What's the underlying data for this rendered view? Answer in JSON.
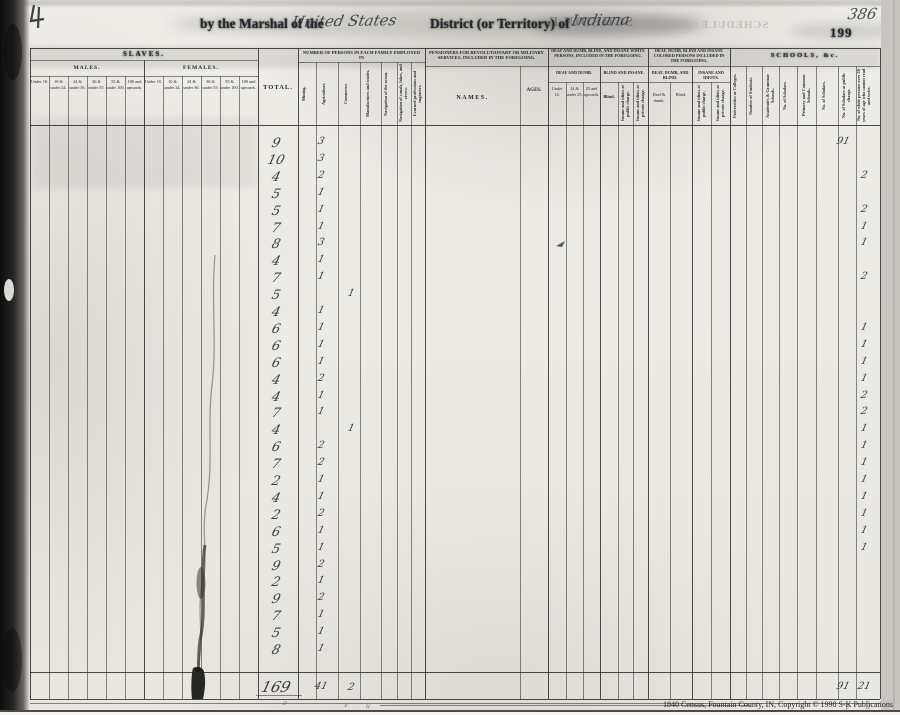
{
  "page": {
    "header": {
      "printed_prefix": "by the Marshal of the",
      "handwritten_region": "United States",
      "printed_middle": "District (or Territory) of",
      "handwritten_state": "Indiana",
      "ghost_bleedthrough": "SCHEDULE",
      "handwritten_page_no": "386",
      "printed_page_no": "199"
    },
    "footer": {
      "caption": "1840 Census, Fountain County, IN, Copyright © 1998 S-K Publications"
    }
  },
  "table": {
    "slaves": {
      "title": "SLAVES.",
      "males_title": "MALES.",
      "females_title": "FEMALES.",
      "age_cols": [
        "Under 10.",
        "10 & under 24.",
        "24 & under 36.",
        "36 & under 55.",
        "55 & under 100.",
        "100 and upwards."
      ]
    },
    "total_col": {
      "title": "TOTAL."
    },
    "employment": {
      "title": "NUMBER OF PERSONS IN EACH FAMILY EMPLOYED IN",
      "cols": [
        "Mining.",
        "Agriculture.",
        "Commerce.",
        "Manufactures and trades.",
        "Navigation of the ocean.",
        "Navigation of canals, lakes, and rivers.",
        "Learned professions and engineers."
      ]
    },
    "pensioners": {
      "title": "PENSIONERS FOR REVOLUTIONARY OR MILITARY SERVICES, INCLUDED IN THE FOREGOING.",
      "names_col": "NAMES.",
      "ages_col": "AGES."
    },
    "white_impaired": {
      "title": "DEAF AND DUMB, BLIND, AND INSANE WHITE PERSONS, INCLUDED IN THE FOREGOING.",
      "deaf_title": "DEAF AND DUMB.",
      "deaf_cols": [
        "Under 14.",
        "14 & under 25.",
        "25 and upwards."
      ],
      "blind_title": "BLIND AND INSANE.",
      "blind_col": "Blind.",
      "insane_cols": [
        "Insane and idiots at public charge.",
        "Insane and idiots at private charge."
      ]
    },
    "colored_impaired": {
      "title": "DEAF, DUMB, BLIND AND INSANE COLORED PERSONS INCLUDED IN THE FOREGOING.",
      "deaf_title": "DEAF, DUMB, AND BLIND.",
      "deaf_cols": [
        "Deaf & dumb.",
        "Blind."
      ],
      "insane_title": "INSANE AND IDIOTS.",
      "insane_cols": [
        "Insane and idiots at public charge.",
        "Insane and idiots at private charge."
      ]
    },
    "schools": {
      "title": "SCHOOLS, &c.",
      "cols": [
        "Universities or Colleges.",
        "Number of Students.",
        "Academies & Grammar Schools.",
        "No. of Scholars.",
        "Primary and Common Schools.",
        "No. of Scholars.",
        "No. of Scholars at public charge.",
        "No. of white persons over 20 years of age who cannot read and write."
      ]
    }
  },
  "records": {
    "columns": [
      "total",
      "agriculture",
      "commerce",
      "scholars",
      "illiterate"
    ],
    "rows": [
      {
        "total": "9",
        "agriculture": "3",
        "scholars": "91"
      },
      {
        "total": "10",
        "agriculture": "3"
      },
      {
        "total": "4",
        "agriculture": "2",
        "illiterate": "2"
      },
      {
        "total": "5",
        "agriculture": "1"
      },
      {
        "total": "5",
        "agriculture": "1",
        "illiterate": "2"
      },
      {
        "total": "7",
        "agriculture": "1",
        "illiterate": "1"
      },
      {
        "total": "8",
        "agriculture": "3",
        "illiterate": "1"
      },
      {
        "total": "4",
        "agriculture": "1"
      },
      {
        "total": "7",
        "agriculture": "1",
        "illiterate": "2"
      },
      {
        "total": "5",
        "commerce": "1"
      },
      {
        "total": "4",
        "agriculture": "1"
      },
      {
        "total": "6",
        "agriculture": "1",
        "illiterate": "1"
      },
      {
        "total": "6",
        "agriculture": "1",
        "illiterate": "1"
      },
      {
        "total": "6",
        "agriculture": "1",
        "illiterate": "1"
      },
      {
        "total": "4",
        "agriculture": "2",
        "illiterate": "1"
      },
      {
        "total": "4",
        "agriculture": "1",
        "illiterate": "2"
      },
      {
        "total": "7",
        "agriculture": "1",
        "illiterate": "2"
      },
      {
        "total": "4",
        "commerce": "1",
        "illiterate": "1"
      },
      {
        "total": "6",
        "agriculture": "2",
        "illiterate": "1"
      },
      {
        "total": "7",
        "agriculture": "2",
        "illiterate": "1"
      },
      {
        "total": "2",
        "agriculture": "1",
        "illiterate": "1"
      },
      {
        "total": "4",
        "agriculture": "1",
        "illiterate": "1"
      },
      {
        "total": "2",
        "agriculture": "2",
        "illiterate": "1"
      },
      {
        "total": "6",
        "agriculture": "1",
        "illiterate": "1"
      },
      {
        "total": "5",
        "agriculture": "1",
        "illiterate": "1"
      },
      {
        "total": "9",
        "agriculture": "2"
      },
      {
        "total": "2",
        "agriculture": "1"
      },
      {
        "total": "9",
        "agriculture": "2"
      },
      {
        "total": "7",
        "agriculture": "1"
      },
      {
        "total": "5",
        "agriculture": "1"
      },
      {
        "total": "8",
        "agriculture": "1"
      }
    ],
    "totals": {
      "total": "169",
      "agriculture": "41",
      "commerce": "2",
      "scholars": "91",
      "illiterate": "21"
    }
  }
}
